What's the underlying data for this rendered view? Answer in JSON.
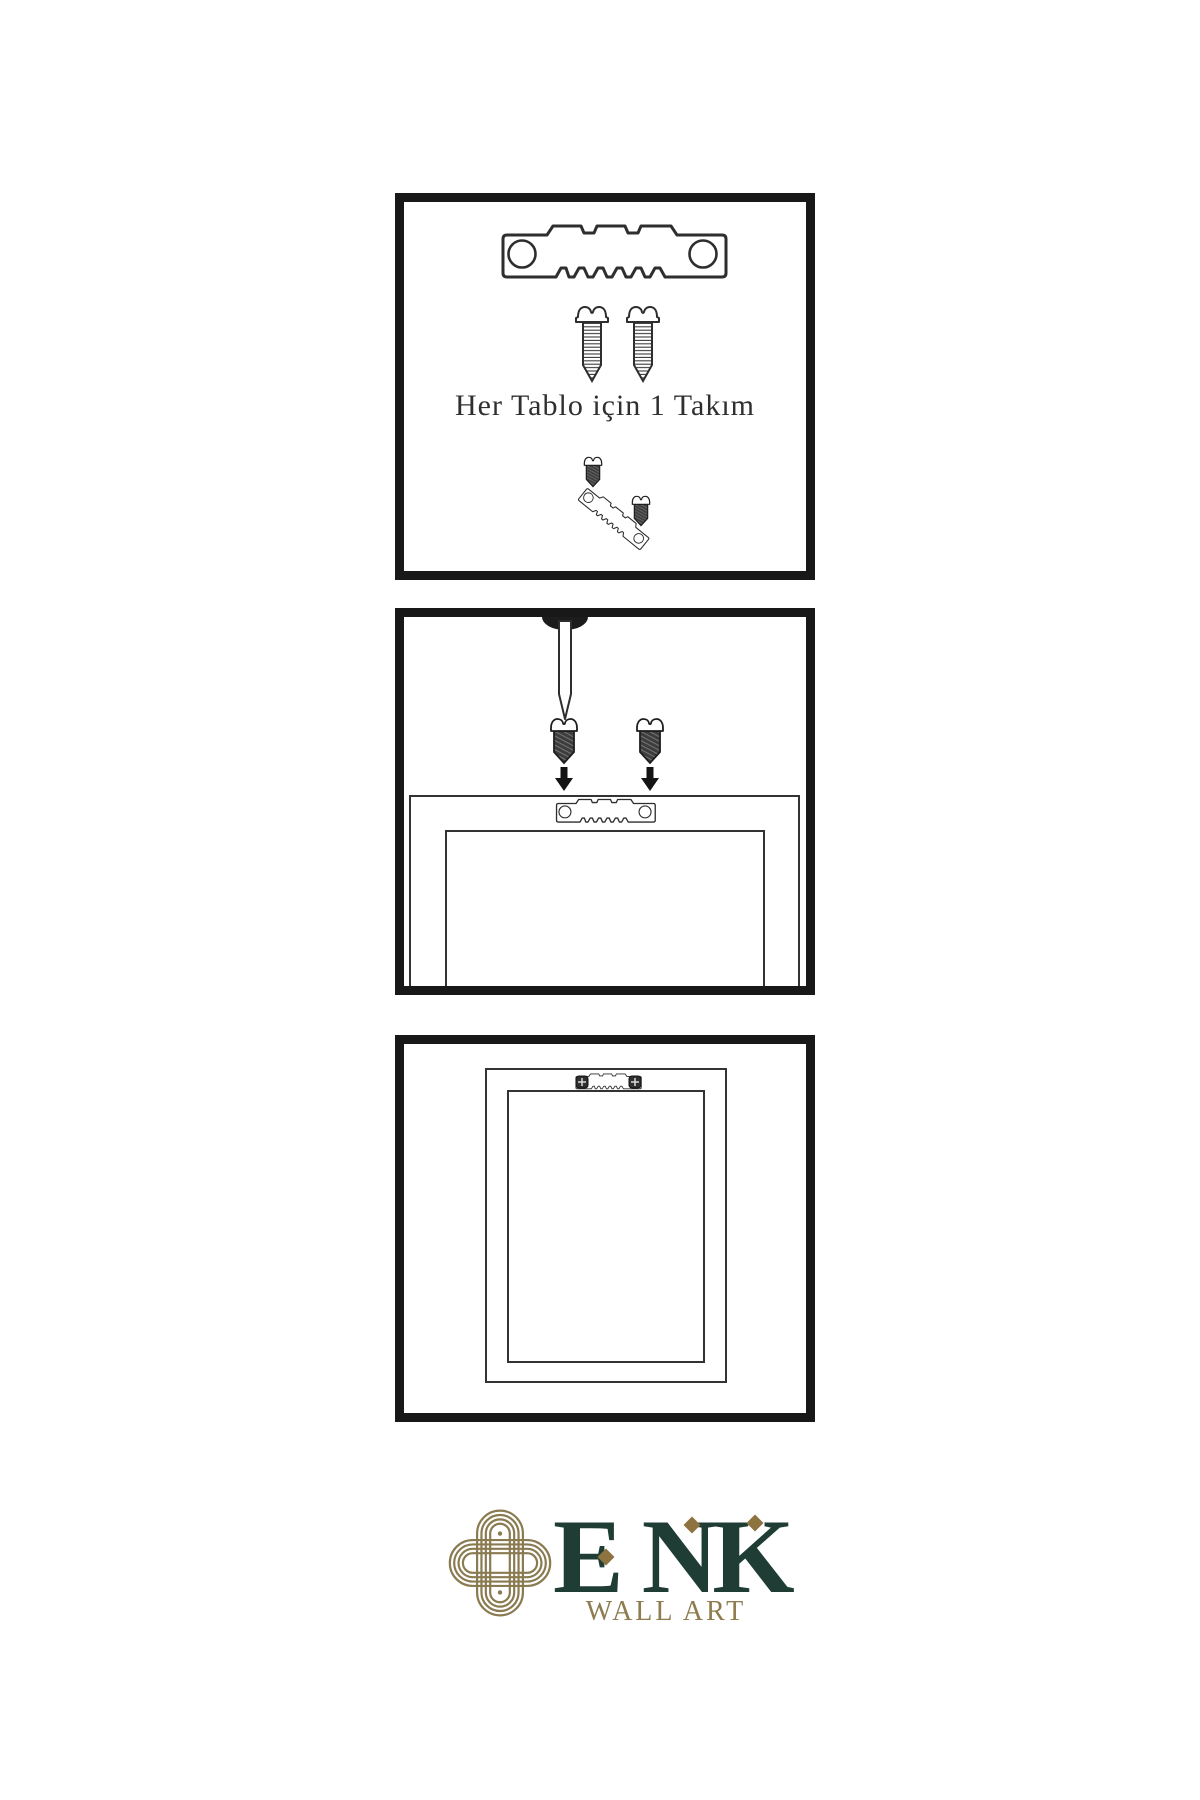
{
  "page": {
    "background": "#ffffff",
    "description": "Wall art hanging hardware instruction sheet with three illustrated steps and brand logo"
  },
  "steps": [
    {
      "name": "hardware-kit",
      "caption": "Her Tablo için 1 Takım",
      "icons": [
        "sawtooth-hanger-icon",
        "screw-icon",
        "screw-icon",
        "tilted-sawtooth-hanger-icon",
        "dark-screw-icon",
        "dark-screw-icon"
      ]
    },
    {
      "name": "attach-hanger-to-frame",
      "icons": [
        "nail-icon",
        "dark-screw-icon",
        "dark-screw-icon",
        "arrow-down-icon",
        "arrow-down-icon",
        "sawtooth-hanger-icon",
        "frame-back-icon"
      ]
    },
    {
      "name": "frame-mounted",
      "icons": [
        "mounted-sawtooth-hanger-icon",
        "screw-head-icon",
        "screw-head-icon",
        "frame-back-icon"
      ]
    }
  ],
  "brand": {
    "logo": "knot-logo-icon",
    "name": "ENK",
    "tagline": "WALL ART",
    "colors": {
      "green": "#1f3d34",
      "gold": "#8e7c4e",
      "knot_gold": "#8a7a50",
      "diamond_gold": "#8d7340"
    }
  },
  "drawing": {
    "panel_border_color": "#181818",
    "line_color": "#2e2e2e",
    "dark_fill_color": "#3d3d3d",
    "caption_color": "#2f2f2f"
  }
}
